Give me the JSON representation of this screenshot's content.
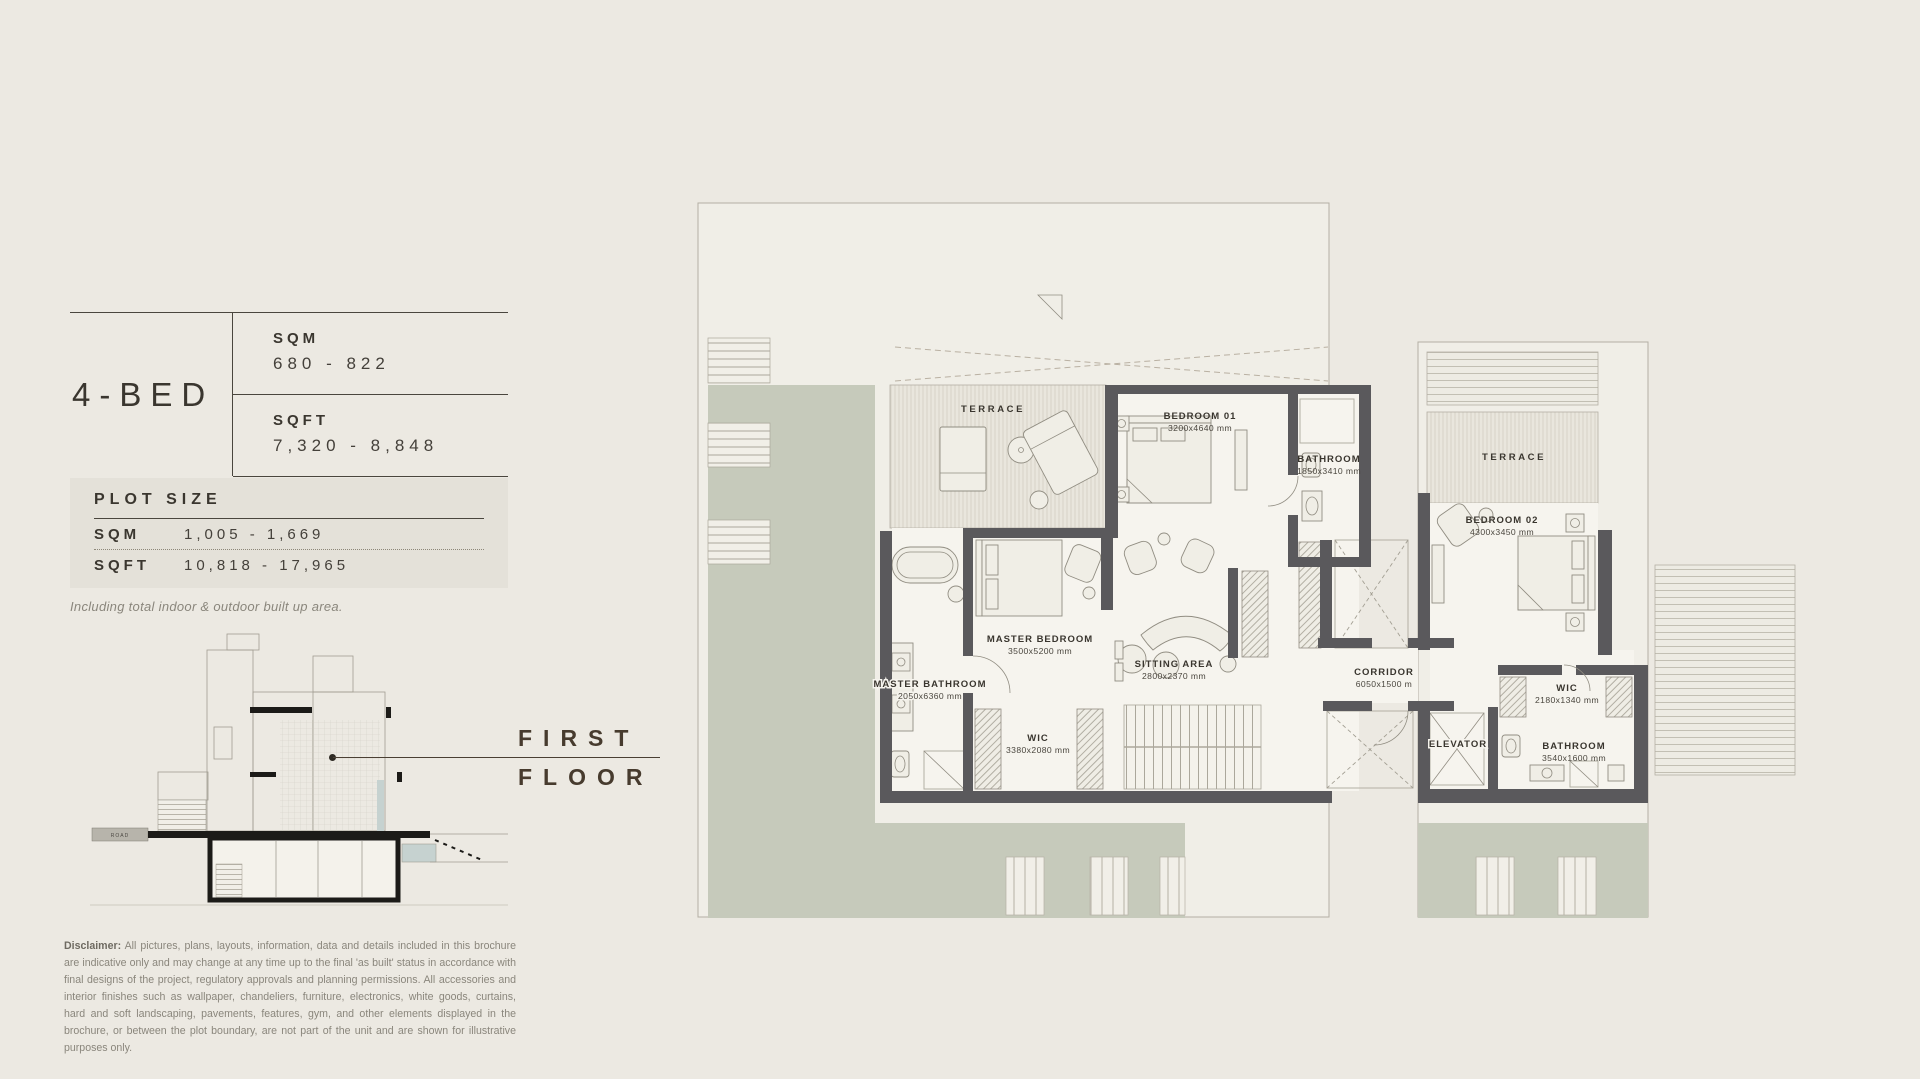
{
  "brochure": {
    "unit_name": "4-BED",
    "area": {
      "sqm_label": "SQM",
      "sqm_value": "680 - 822",
      "sqft_label": "SQFT",
      "sqft_value": "7,320 - 8,848"
    },
    "plot": {
      "title": "PLOT SIZE",
      "sqm_label": "SQM",
      "sqm_value": "1,005 - 1,669",
      "sqft_label": "SQFT",
      "sqft_value": "10,818 - 17,965",
      "note": "Including total indoor & outdoor built up area."
    },
    "floor_label": {
      "line1": "FIRST",
      "line2": "FLOOR"
    },
    "section": {
      "road": "ROAD"
    },
    "disclaimer": {
      "label": "Disclaimer:",
      "text": " All pictures, plans, layouts, information, data and details included in this brochure are indicative only and may change at any time up to the final 'as built' status in accordance with final designs of the project, regulatory approvals and planning permissions. All accessories and interior finishes such as wallpaper, chandeliers, furniture, electronics, white goods, curtains, hard and soft landscaping, pavements, features, gym, and other elements displayed in the brochure, or between the plot boundary, are not part of the unit and are shown for illustrative purposes only."
    }
  },
  "plan": {
    "rooms": [
      {
        "name": "TERRACE",
        "dims": ""
      },
      {
        "name": "BEDROOM 01",
        "dims": "3200x4640 mm"
      },
      {
        "name": "BATHROOM",
        "dims": "1850x3410 mm"
      },
      {
        "name": "TERRACE",
        "dims": ""
      },
      {
        "name": "BEDROOM 02",
        "dims": "4300x3450 mm"
      },
      {
        "name": "MASTER BEDROOM",
        "dims": "3500x5200 mm"
      },
      {
        "name": "SITTING AREA",
        "dims": "2800x2370 mm"
      },
      {
        "name": "CORRIDOR",
        "dims": "6050x1500 m"
      },
      {
        "name": "MASTER BATHROOM",
        "dims": "2050x6360 mm"
      },
      {
        "name": "WIC",
        "dims": "3380x2080 mm"
      },
      {
        "name": "WIC",
        "dims": "2180x1340 mm"
      },
      {
        "name": "ELEVATOR",
        "dims": ""
      },
      {
        "name": "BATHROOM",
        "dims": "3540x1600 mm"
      }
    ]
  },
  "colors": {
    "page_bg": "#ECE9E2",
    "panel_bg": "#E4E1D9",
    "ink": "#3A362F",
    "brown": "#473B2E",
    "muted": "#8A867C",
    "wall": "#5A595C",
    "green": "#C6CABB",
    "floor": "#F6F4EE",
    "site": "#F0EEE7",
    "terrace": "#E9E6DD",
    "stripe": "#D6D3C7",
    "outline": "#B3AFA4",
    "pool": "#C6D2D0"
  }
}
